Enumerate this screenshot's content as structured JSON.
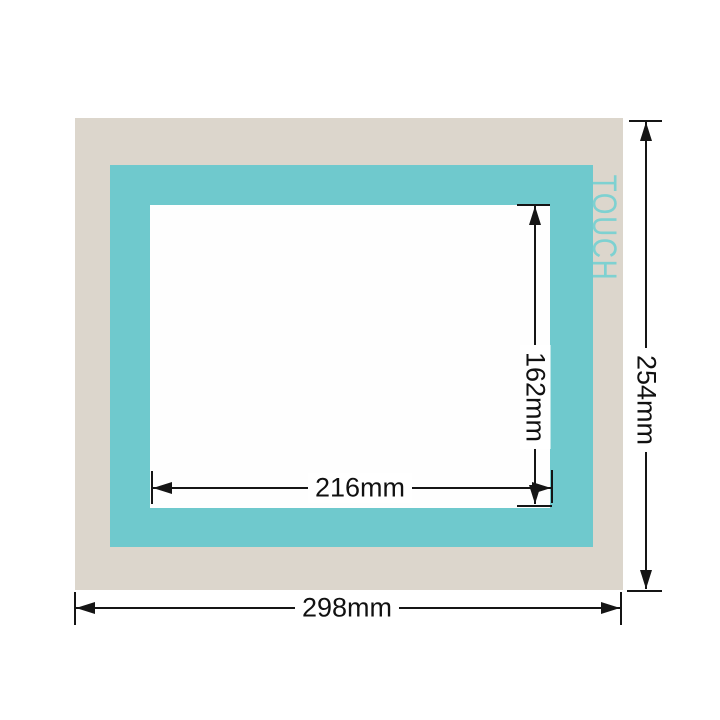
{
  "diagram": {
    "title": "touch-panel-protective-overlay-dimension-diagram",
    "touch_label": "TOUCH",
    "dimensions": {
      "window_width": "216mm",
      "window_height": "162mm",
      "panel_width": "298mm",
      "panel_height": "254mm"
    },
    "colors": {
      "bezel_beige": "#dcd6cc",
      "frame_teal": "#6fc9cd",
      "window_white": "#fefefe",
      "dimension_line": "#151515",
      "touch_text": "#7ed1d1",
      "background": "#ffffff"
    }
  }
}
